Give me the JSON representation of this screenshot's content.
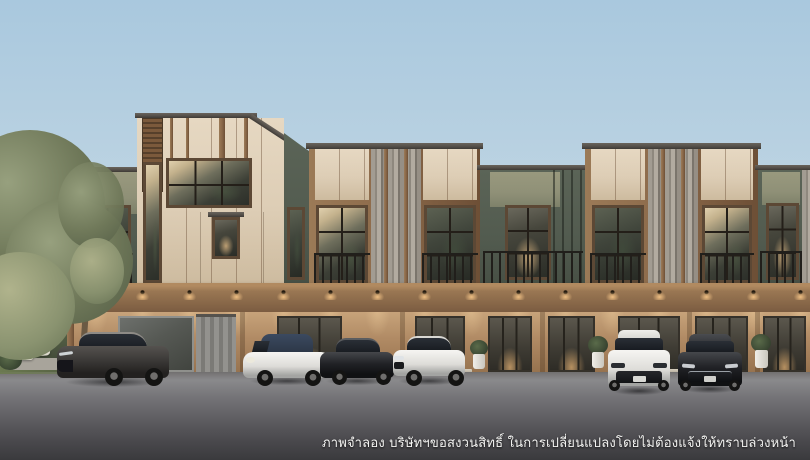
{
  "disclaimer": {
    "text": "ภาพจำลอง บริษัทฯขอสงวนสิทธิ์ ในการเปลี่ยนแปลงโดยไม่ต้องแจ้งให้ทราบล่วงหน้า"
  },
  "palette": {
    "sky_top": "#a9c8de",
    "sky_bottom": "#d4e4ee",
    "cream": "#ddcdb5",
    "cream_dark": "#cdbb9f",
    "wood": "#8a6849",
    "wood_dark": "#5f4630",
    "fascia": "#55504a",
    "green_olive": "#8f9077",
    "green_dark": "#525b4f",
    "stone_light": "#a29c92",
    "stone_dark": "#7b756c",
    "band_light": "#b18a60",
    "band_dark": "#7b5c41",
    "wall_lit": "#c7a37a",
    "wall_dark": "#97734f",
    "glass_dark": "#2c2f29",
    "warm_light": "#e8c089",
    "road_light": "#8b8b8d",
    "road_dark": "#3a3a3d",
    "text_color": "#f4f4f2"
  },
  "scene": {
    "subject": "three-storey-townhome-row-rendering",
    "objects": {
      "cars": [
        {
          "name": "suv-dark-gray",
          "color": "#3f3d3b"
        },
        {
          "name": "convertible-white-navy-top",
          "color": "#f4f3f0"
        },
        {
          "name": "sedan-black",
          "color": "#17181a"
        },
        {
          "name": "sedan-white",
          "color": "#f6f5f2"
        },
        {
          "name": "sedan-white-front-view",
          "color": "#f6f5f2"
        },
        {
          "name": "sedan-dark-front-view",
          "color": "#26282c"
        }
      ],
      "landscape": [
        "tree-canopy",
        "hedge",
        "outdoor-cushions",
        "planter-boxes",
        "potted-plants"
      ]
    }
  }
}
